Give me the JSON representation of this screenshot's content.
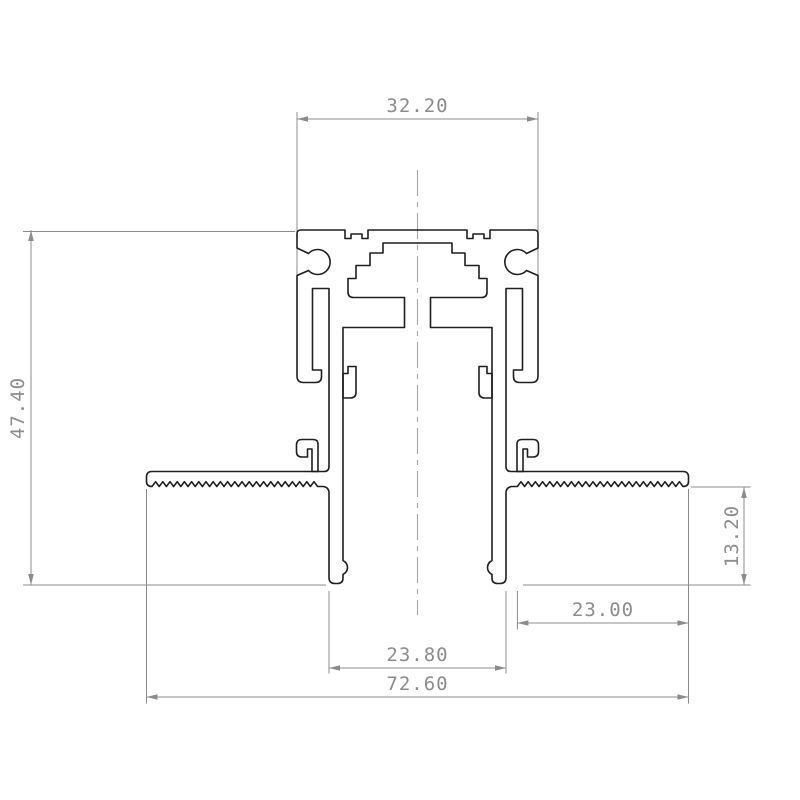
{
  "drawing": {
    "title": "aluminium-profile-cross-section",
    "background": "#ffffff",
    "profile_line_color": "#1f1f1f",
    "dimension_color": "#8c8c8c",
    "dimensions": {
      "top_width": "32.20",
      "overall_height": "47.40",
      "flange_height": "13.20",
      "right_flange_width": "23.00",
      "base_width": "23.80",
      "overall_width": "72.60"
    }
  }
}
